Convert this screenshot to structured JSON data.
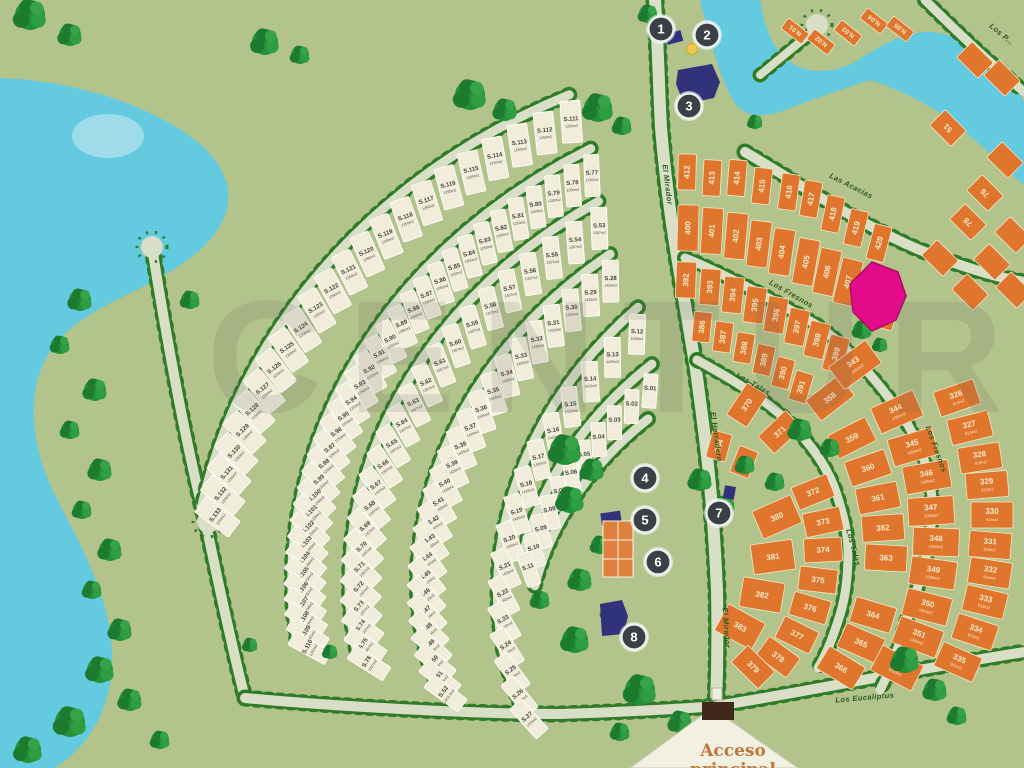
{
  "watermark": "CENTUR",
  "entrance": {
    "line1": "Acceso",
    "line2": "principal"
  },
  "colors": {
    "background": "#b2c38b",
    "water": "#63cadf",
    "pond": "#9fdce9",
    "road": "#d9dfc6",
    "road_dots": "#2e7b28",
    "cream_lot": "#f2edda",
    "cream_lot_text": "#46443c",
    "orange_lot": "#e0762e",
    "orange_lot_text": "#faeccb",
    "marker": "#3a4046",
    "building": "#30327a",
    "court": "#df813c",
    "highlight_pink": "#e40b8a",
    "gate": "#40291c",
    "accent_text": "#c0763a"
  },
  "markers": [
    {
      "n": "1",
      "x": 661,
      "y": 29
    },
    {
      "n": "2",
      "x": 707,
      "y": 35
    },
    {
      "n": "3",
      "x": 689,
      "y": 106
    },
    {
      "n": "4",
      "x": 645,
      "y": 478
    },
    {
      "n": "5",
      "x": 645,
      "y": 520
    },
    {
      "n": "6",
      "x": 658,
      "y": 562
    },
    {
      "n": "7",
      "x": 719,
      "y": 513
    },
    {
      "n": "8",
      "x": 634,
      "y": 637
    }
  ],
  "streets": [
    {
      "name": "El Mirador",
      "x": 665,
      "y": 185,
      "rot": 83
    },
    {
      "name": "El Mirador",
      "x": 724,
      "y": 628,
      "rot": 86
    },
    {
      "name": "El Herradero",
      "x": 714,
      "y": 437,
      "rot": 82
    },
    {
      "name": "Las Acacias",
      "x": 850,
      "y": 188,
      "rot": 27
    },
    {
      "name": "Los Fresnos",
      "x": 790,
      "y": 296,
      "rot": 30
    },
    {
      "name": "Los Fresnos",
      "x": 934,
      "y": 450,
      "rot": 70
    },
    {
      "name": "Los Talas",
      "x": 752,
      "y": 386,
      "rot": 30
    },
    {
      "name": "Los Talas",
      "x": 851,
      "y": 548,
      "rot": 75
    },
    {
      "name": "Los Eucaliptus",
      "x": 865,
      "y": 700,
      "rot": -5
    },
    {
      "name": "Los P...",
      "x": 1000,
      "y": 36,
      "rot": 40
    }
  ],
  "cream_rings": [
    {
      "ring": "R1",
      "default_area": "1250m2",
      "lots": [
        "S.111",
        "S.112",
        "S.113",
        "S.114",
        "S.115",
        "S.116",
        "S.117",
        "S.118",
        "S.119",
        "S.120",
        "S.121",
        "S.122",
        "S.123",
        "S.124",
        "S.125",
        "S.126",
        "S.127",
        "S.128",
        "S.129",
        "S.130",
        "S.131",
        "S.132",
        "S.133"
      ]
    },
    {
      "ring": "R2",
      "default_area": "1250m2",
      "lots": [
        "S.77",
        "S.78",
        "S.79",
        "S.80",
        "S.81",
        "S.82",
        "S.83",
        "S.84",
        "S.85",
        "S.86",
        "S.87",
        "S.88",
        "S.89",
        "S.90",
        "S.91",
        "S.92",
        "S.93",
        "S.94",
        "S.95",
        "S.96",
        "S.97",
        "S.98",
        "S.99",
        "S.100",
        "S.101",
        "S.102",
        "S.103",
        "S.104",
        "S.105",
        "S.106",
        "S.107",
        "S.108",
        "S.109",
        "S.110"
      ]
    },
    {
      "ring": "R3",
      "default_area": "1307m2",
      "lots": [
        "S.53",
        "S.54",
        "S.55",
        "S.56",
        "S.57",
        "S.58",
        "S.59",
        "S.60",
        "S.61",
        "S.62",
        "S.63",
        "S.64",
        "S.65",
        "S.66",
        "S.67",
        "S.68",
        "S.69",
        "S.70",
        "S.71",
        "S.72",
        "S.73",
        "S.74",
        "S.75",
        "S.76"
      ]
    },
    {
      "ring": "R4",
      "default_area": "1425m2",
      "lots": [
        "S.28",
        "S.29",
        "S.30",
        "S.31",
        "S.32",
        "S.33",
        "S.34",
        "S.35",
        "S.36",
        "S.37",
        "S.38",
        "S.39",
        "S.40",
        "S.41",
        "S.42",
        "S.43",
        "S.44",
        "S.45",
        "S.46",
        "S.47",
        "S.48",
        "S.49",
        "S.50",
        "S.51",
        "S.52"
      ]
    },
    {
      "ring": "R5",
      "default_area": "1425m2",
      "lots": [
        "S.12",
        "S.13",
        "S.14",
        "S.15",
        "S.16",
        "S.17",
        "S.18",
        "S.19",
        "S.20",
        "S.21",
        "S.22",
        "S.23",
        "S.24",
        "S.25",
        "S.26",
        "S.27"
      ]
    },
    {
      "ring": "R6",
      "default_area": "",
      "lots": [
        "S.01",
        "S.02",
        "S.03",
        "S.04",
        "S.05",
        "S.06",
        "S.07",
        "S.08",
        "S.09",
        "S.10",
        "S.11"
      ]
    }
  ],
  "cream_area_specials": {
    "S.52": "2315.6m2",
    "S.22": "2365m2"
  },
  "orange_groups": [
    {
      "name": "row-412",
      "w": 18,
      "h": 36,
      "focal": [
        665,
        1050
      ],
      "default_area": "",
      "lots": [
        {
          "id": "412",
          "x": 687,
          "y": 172
        },
        {
          "id": "413",
          "x": 712,
          "y": 178
        },
        {
          "id": "414",
          "x": 737,
          "y": 178
        },
        {
          "id": "415",
          "x": 762,
          "y": 186
        },
        {
          "id": "416",
          "x": 789,
          "y": 192
        },
        {
          "id": "417",
          "x": 811,
          "y": 199
        },
        {
          "id": "418",
          "x": 833,
          "y": 214
        },
        {
          "id": "419",
          "x": 856,
          "y": 228
        },
        {
          "id": "420",
          "x": 879,
          "y": 243
        }
      ]
    },
    {
      "name": "row-400",
      "w": 21,
      "h": 46,
      "focal": [
        665,
        1050
      ],
      "default_area": "",
      "lots": [
        {
          "id": "400",
          "x": 688,
          "y": 228
        },
        {
          "id": "401",
          "x": 712,
          "y": 231
        },
        {
          "id": "402",
          "x": 736,
          "y": 236
        },
        {
          "id": "403",
          "x": 759,
          "y": 244
        },
        {
          "id": "404",
          "x": 782,
          "y": 252
        },
        {
          "id": "405",
          "x": 806,
          "y": 262
        },
        {
          "id": "406",
          "x": 827,
          "y": 272
        },
        {
          "id": "407",
          "x": 848,
          "y": 282
        },
        {
          "id": "408",
          "x": 868,
          "y": 293
        },
        {
          "id": "409",
          "x": 888,
          "y": 306
        }
      ]
    },
    {
      "name": "row-392",
      "w": 20,
      "h": 36,
      "focal": [
        660,
        1000
      ],
      "default_area": "",
      "lots": [
        {
          "id": "392",
          "x": 686,
          "y": 280
        },
        {
          "id": "393",
          "x": 710,
          "y": 287
        },
        {
          "id": "394",
          "x": 733,
          "y": 295
        },
        {
          "id": "395",
          "x": 755,
          "y": 305
        },
        {
          "id": "396",
          "x": 776,
          "y": 315
        },
        {
          "id": "397",
          "x": 797,
          "y": 327
        },
        {
          "id": "398",
          "x": 817,
          "y": 340
        },
        {
          "id": "399",
          "x": 836,
          "y": 354
        }
      ]
    },
    {
      "name": "row-386",
      "w": 18,
      "h": 30,
      "focal": [
        650,
        900
      ],
      "default_area": "",
      "lots": [
        {
          "id": "386",
          "x": 702,
          "y": 327
        },
        {
          "id": "387",
          "x": 723,
          "y": 337
        },
        {
          "id": "388",
          "x": 744,
          "y": 348
        },
        {
          "id": "389",
          "x": 764,
          "y": 360
        },
        {
          "id": "390",
          "x": 783,
          "y": 373
        },
        {
          "id": "391",
          "x": 801,
          "y": 387
        }
      ]
    },
    {
      "name": "row-384",
      "w": 20,
      "h": 28,
      "focal": [
        650,
        700
      ],
      "default_area": "",
      "lots": [
        {
          "id": "384",
          "x": 719,
          "y": 446
        },
        {
          "id": "385",
          "x": 744,
          "y": 462
        }
      ]
    },
    {
      "name": "ring-380",
      "w": 30,
      "h": 42,
      "focal": [
        645,
        575
      ],
      "default_area": "",
      "lots": [
        {
          "id": "380",
          "x": 777,
          "y": 517
        },
        {
          "id": "381",
          "x": 773,
          "y": 557
        },
        {
          "id": "382",
          "x": 762,
          "y": 595
        },
        {
          "id": "383",
          "x": 740,
          "y": 627
        }
      ]
    },
    {
      "name": "ring-370",
      "w": 24,
      "h": 38,
      "focal": [
        645,
        560
      ],
      "default_area": "",
      "lots": [
        {
          "id": "370",
          "x": 747,
          "y": 405
        },
        {
          "id": "371",
          "x": 780,
          "y": 432
        },
        {
          "id": "372",
          "x": 813,
          "y": 492
        },
        {
          "id": "373",
          "x": 823,
          "y": 522
        },
        {
          "id": "374",
          "x": 823,
          "y": 550
        },
        {
          "id": "375",
          "x": 818,
          "y": 580
        },
        {
          "id": "376",
          "x": 810,
          "y": 608
        },
        {
          "id": "377",
          "x": 797,
          "y": 635
        },
        {
          "id": "378",
          "x": 778,
          "y": 657
        },
        {
          "id": "379",
          "x": 753,
          "y": 667
        }
      ]
    },
    {
      "name": "ring-358",
      "w": 26,
      "h": 42,
      "focal": [
        640,
        545
      ],
      "default_area": "",
      "lots": [
        {
          "id": "358",
          "x": 830,
          "y": 398
        },
        {
          "id": "359",
          "x": 852,
          "y": 438
        },
        {
          "id": "360",
          "x": 868,
          "y": 468
        },
        {
          "id": "361",
          "x": 878,
          "y": 498
        },
        {
          "id": "362",
          "x": 883,
          "y": 528
        },
        {
          "id": "363",
          "x": 886,
          "y": 558
        },
        {
          "id": "364",
          "x": 873,
          "y": 615
        },
        {
          "id": "365",
          "x": 861,
          "y": 643
        },
        {
          "id": "366",
          "x": 841,
          "y": 668
        }
      ]
    },
    {
      "name": "ring-343",
      "w": 28,
      "h": 46,
      "focal": [
        630,
        530
      ],
      "default_area": "1050m2",
      "lots": [
        {
          "id": "343",
          "x": 855,
          "y": 365
        },
        {
          "id": "344",
          "x": 897,
          "y": 412
        },
        {
          "id": "345",
          "x": 913,
          "y": 447
        },
        {
          "id": "346",
          "x": 927,
          "y": 477
        },
        {
          "id": "347",
          "x": 931,
          "y": 511
        },
        {
          "id": "348",
          "x": 936,
          "y": 542
        },
        {
          "id": "349",
          "x": 933,
          "y": 573
        },
        {
          "id": "350",
          "x": 927,
          "y": 607
        },
        {
          "id": "351",
          "x": 918,
          "y": 637
        },
        {
          "id": "352",
          "x": 897,
          "y": 668
        }
      ]
    },
    {
      "name": "ring-326",
      "w": 26,
      "h": 42,
      "focal": [
        620,
        515
      ],
      "default_area": "913m2",
      "lots": [
        {
          "id": "326",
          "x": 957,
          "y": 398
        },
        {
          "id": "327",
          "x": 970,
          "y": 428
        },
        {
          "id": "328",
          "x": 980,
          "y": 458
        },
        {
          "id": "329",
          "x": 987,
          "y": 485
        },
        {
          "id": "330",
          "x": 992,
          "y": 515
        },
        {
          "id": "331",
          "x": 990,
          "y": 545
        },
        {
          "id": "332",
          "x": 990,
          "y": 573
        },
        {
          "id": "333",
          "x": 985,
          "y": 602
        },
        {
          "id": "334",
          "x": 975,
          "y": 632
        },
        {
          "id": "335",
          "x": 958,
          "y": 662
        }
      ]
    },
    {
      "name": "n-lots",
      "w": 13,
      "h": 26,
      "rot": -52,
      "default_area": "",
      "lots": [
        {
          "id": "N.01",
          "x": 795,
          "y": 31
        },
        {
          "id": "N.02",
          "x": 821,
          "y": 42
        },
        {
          "id": "N.03",
          "x": 848,
          "y": 33
        },
        {
          "id": "N.04",
          "x": 874,
          "y": 21
        },
        {
          "id": "N.05",
          "x": 900,
          "y": 29
        }
      ]
    },
    {
      "name": "east-grid",
      "w": 22,
      "h": 30,
      "rot": -45,
      "default_area": "",
      "lots": [
        {
          "id": "51",
          "x": 948,
          "y": 128
        },
        {
          "id": "76",
          "x": 985,
          "y": 193
        },
        {
          "id": "78",
          "x": 968,
          "y": 222
        },
        {
          "id": "",
          "x": 1005,
          "y": 160
        },
        {
          "id": "",
          "x": 1013,
          "y": 235
        },
        {
          "id": "",
          "x": 940,
          "y": 258
        },
        {
          "id": "",
          "x": 992,
          "y": 262
        },
        {
          "id": "",
          "x": 970,
          "y": 292
        },
        {
          "id": "",
          "x": 1014,
          "y": 290
        },
        {
          "id": "",
          "x": 975,
          "y": 60
        },
        {
          "id": "",
          "x": 1002,
          "y": 78
        }
      ]
    }
  ]
}
